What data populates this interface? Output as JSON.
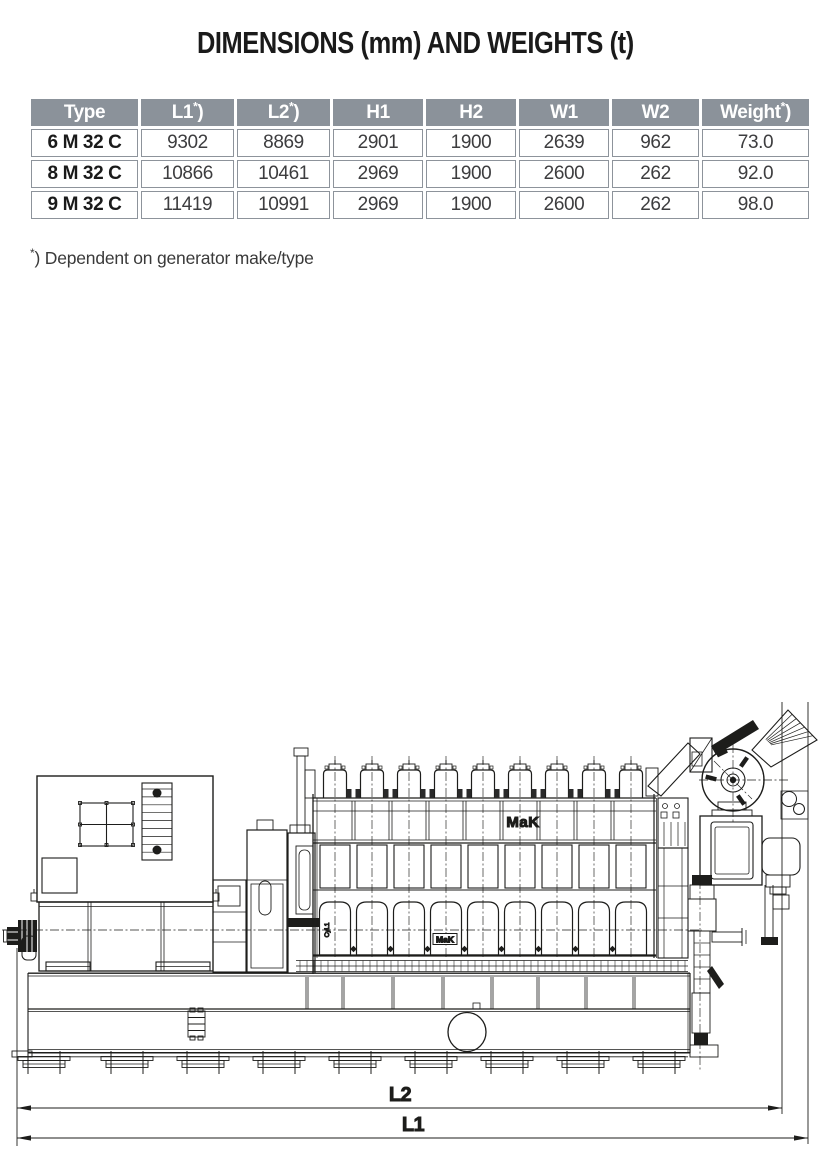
{
  "page": {
    "title": "DIMENSIONS (mm) AND WEIGHTS (t)"
  },
  "table": {
    "header_bg": "#8b929a",
    "header_text_color": "#ffffff",
    "border_color": "#8d939b",
    "star_suffix": {
      "sup": "*",
      "after": ")"
    },
    "columns": [
      {
        "label": "Type",
        "star": false
      },
      {
        "label": "L1",
        "star": true
      },
      {
        "label": "L2",
        "star": true
      },
      {
        "label": "H1",
        "star": false
      },
      {
        "label": "H2",
        "star": false
      },
      {
        "label": "W1",
        "star": false
      },
      {
        "label": "W2",
        "star": false
      },
      {
        "label": "Weight",
        "star": true
      }
    ],
    "rows": [
      {
        "type": "6 M 32 C",
        "values": [
          "9302",
          "8869",
          "2901",
          "1900",
          "2639",
          "962",
          "73.0"
        ]
      },
      {
        "type": "8 M 32 C",
        "values": [
          "10866",
          "10461",
          "2969",
          "1900",
          "2600",
          "262",
          "92.0"
        ]
      },
      {
        "type": "9 M 32 C",
        "values": [
          "11419",
          "10991",
          "2969",
          "1900",
          "2600",
          "262",
          "98.0"
        ]
      }
    ]
  },
  "footnote": {
    "star": "*",
    "text": ") Dependent on generator make/type"
  },
  "diagram": {
    "cylinders": 9,
    "engine_brand": "MaK",
    "engine_brand_small": "MaK",
    "cylinder_label": "Cyl.1",
    "dimension_labels": {
      "l2": "L2",
      "l1": "L1"
    },
    "line_color": "#1d1d1b"
  }
}
